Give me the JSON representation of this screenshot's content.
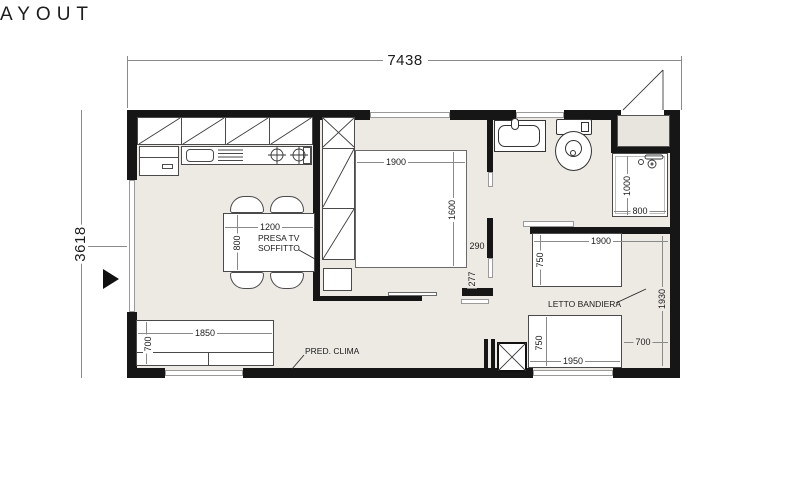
{
  "title": "AYOUT",
  "colors": {
    "floor": "#edeae3",
    "wall": "#161616",
    "accent_line": "#4a4a4a"
  },
  "overall_dimensions": {
    "width": "7438",
    "height": "3618"
  },
  "living_area": {
    "table": {
      "width": "1200",
      "depth": "800"
    },
    "sofa": {
      "width": "1850",
      "depth": "700"
    },
    "presa_tv_note": "PRESA TV\nSOFFITTO",
    "pred_clima_note": "PRED. CLIMA"
  },
  "bedroom_main": {
    "bed_width": "1900",
    "bed_depth": "1600",
    "wall_dim_a": "290",
    "wall_dim_b": "277"
  },
  "bathroom": {
    "shower_depth": "1000",
    "shower_width": "800"
  },
  "bedroom_rear": {
    "label": "LETTO BANDIERA",
    "bed_top_width": "1900",
    "bed_top_depth": "750",
    "bed_bottom_width": "1950",
    "bed_bottom_depth": "750",
    "room_length": "1930",
    "side_gap": "700"
  }
}
